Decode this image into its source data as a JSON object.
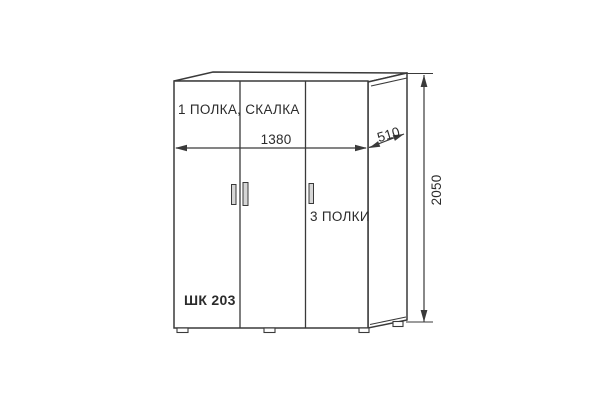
{
  "diagram": {
    "product_code": "ШК 203",
    "annotation_top_shelf": "1 ПОЛКА, СКАЛКА",
    "annotation_shelves": "3 ПОЛКИ",
    "dimensions": {
      "width": "1380",
      "depth": "510",
      "height": "2050"
    },
    "colors": {
      "line": "#3a3a3a",
      "text": "#2b2b2b",
      "handle_fill": "#d6d6d6",
      "background": "#ffffff"
    }
  }
}
